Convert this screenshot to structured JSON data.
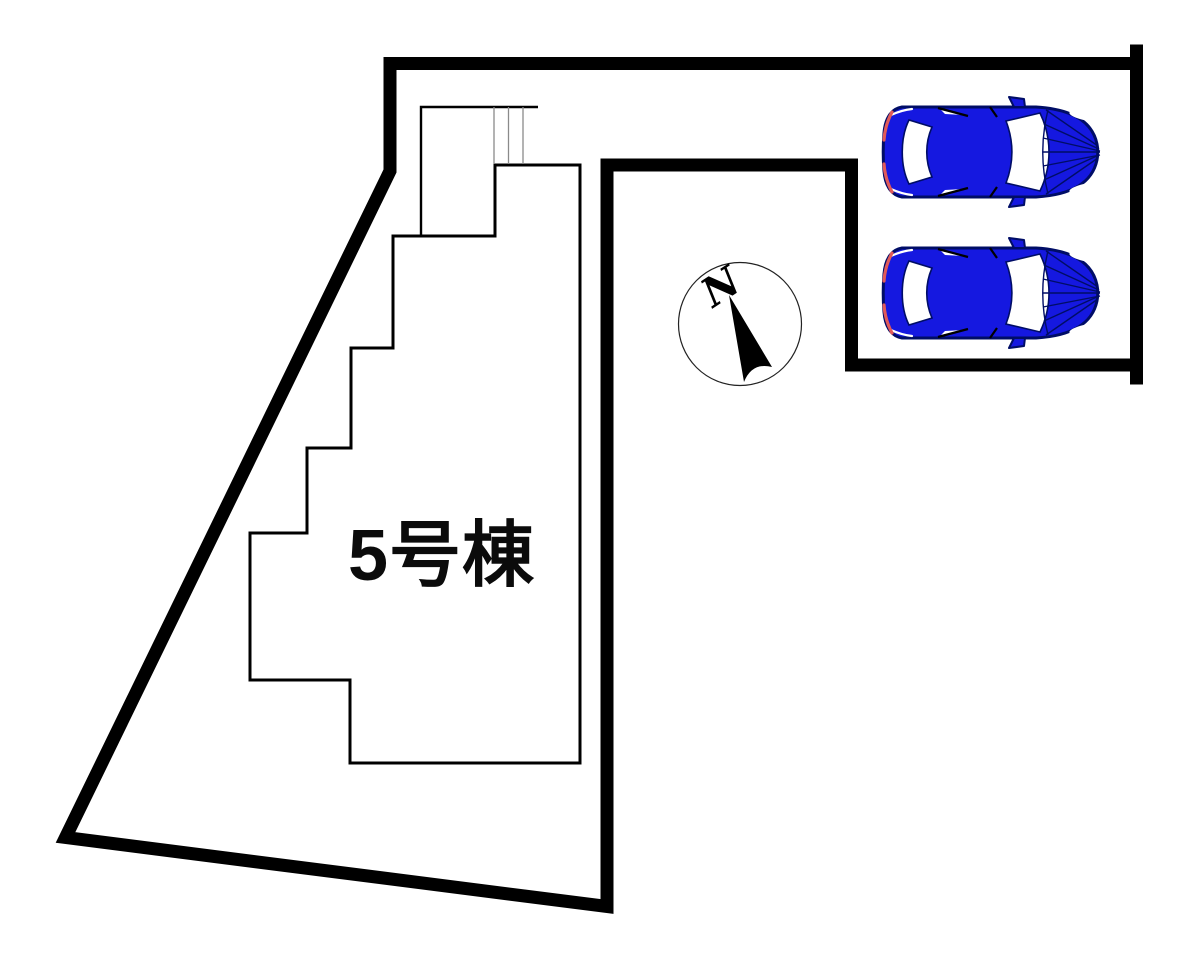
{
  "site_plan": {
    "building_label": "5号棟",
    "compass": {
      "north_label": "N"
    },
    "parking": {
      "cars": [
        "car-1",
        "car-2"
      ],
      "car_count": 2
    },
    "icons": {
      "car": "top-view-car-icon",
      "compass": "north-arrow-compass-icon"
    },
    "colors": {
      "line": "#000000",
      "car_body": "#1518e0",
      "car_outline": "#000d66",
      "tail_light": "#e05a5a"
    }
  }
}
